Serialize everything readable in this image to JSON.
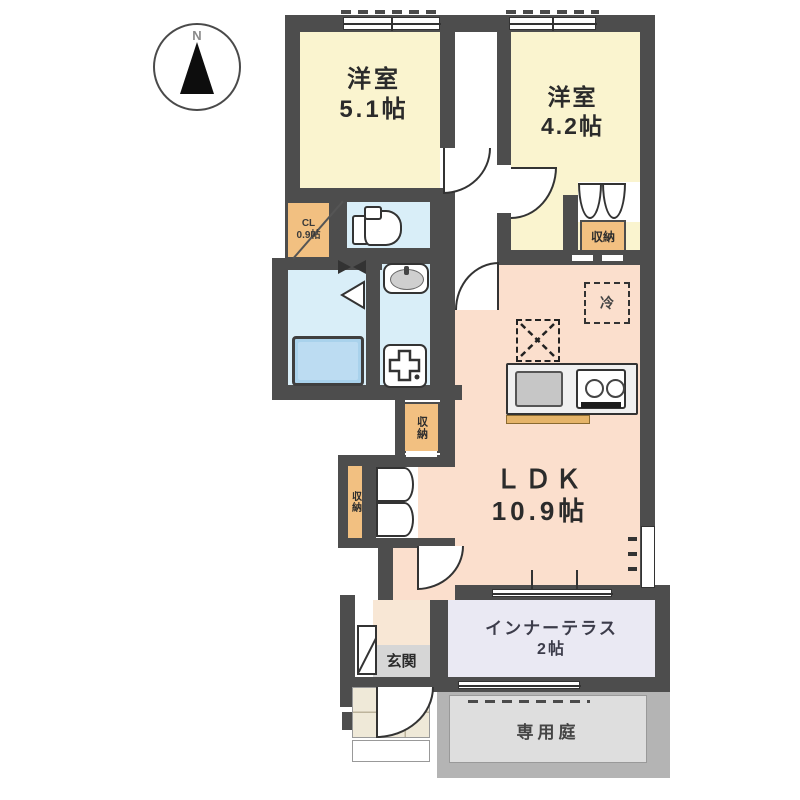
{
  "compass": {
    "label": "N"
  },
  "rooms": {
    "bedroom1": {
      "name": "洋室",
      "size": "5.1帖"
    },
    "bedroom2": {
      "name": "洋室",
      "size": "4.2帖"
    },
    "ldk": {
      "name": "ＬＤＫ",
      "size": "10.9帖"
    },
    "closet_cl": {
      "name": "CL",
      "size": "0.9帖"
    },
    "storage_bedroom2": {
      "name": "収納"
    },
    "storage_hall": {
      "name": "収納"
    },
    "storage_ldk": {
      "name": "収納"
    },
    "refrigerator": {
      "name": "冷"
    },
    "entrance": {
      "name": "玄関"
    },
    "inner_terrace": {
      "name": "インナーテラス",
      "size": "2帖"
    },
    "garden": {
      "name": "専用庭"
    }
  },
  "colors": {
    "wall": "#4d4d4d",
    "bedroom_fill": "#faf4cf",
    "ldk_fill": "#fbdfcd",
    "wet_area_fill": "#d9eef8",
    "bathtub_fill": "#a9d2ec",
    "storage_fill": "#f2c081",
    "terrace_fill": "#eae9f3",
    "garden_fill": "#dcdcdc",
    "entrance_tile_fill": "#efe9d8"
  }
}
